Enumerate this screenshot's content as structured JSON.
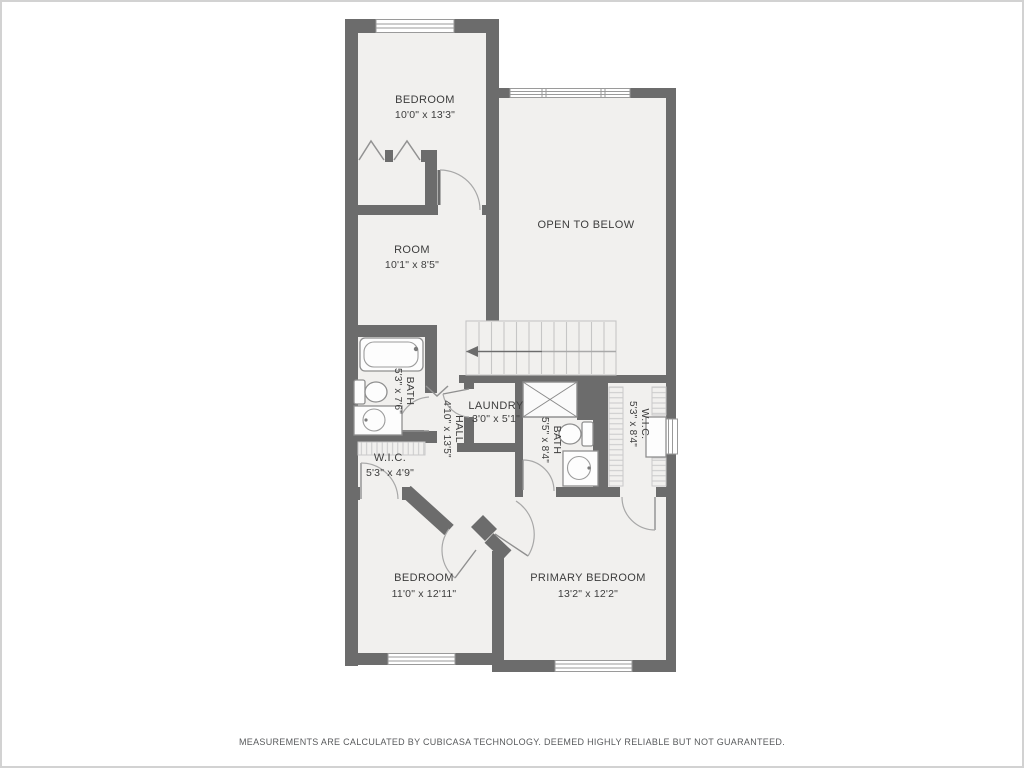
{
  "palette": {
    "wall": "#6c6c6c",
    "room_fill": "#f1f0ee",
    "fixture_stroke": "#8f8f8f",
    "label_text": "#3d3d3d",
    "disclaimer_text": "#585a5c",
    "page_border": "#d2d2d2"
  },
  "rooms": [
    {
      "id": "bedroom-top",
      "name": "BEDROOM",
      "dims": "10'0\" x 13'3\""
    },
    {
      "id": "open-to-below",
      "name": "OPEN TO BELOW",
      "dims": ""
    },
    {
      "id": "room",
      "name": "ROOM",
      "dims": "10'1\" x 8'5\""
    },
    {
      "id": "bath-left",
      "name": "BATH",
      "dims": "5'3\" x 7'6\""
    },
    {
      "id": "hall",
      "name": "HALL",
      "dims": "4'10\" x 13'5\""
    },
    {
      "id": "laundry",
      "name": "LAUNDRY",
      "dims": "3'0\" x 5'1\""
    },
    {
      "id": "bath-middle",
      "name": "BATH",
      "dims": "5'5\" x 8'4\""
    },
    {
      "id": "wic-right",
      "name": "W.I.C.",
      "dims": "5'3\" x 8'4\""
    },
    {
      "id": "wic-left",
      "name": "W.I.C.",
      "dims": "5'3\" x 4'9\""
    },
    {
      "id": "bedroom-bottom",
      "name": "BEDROOM",
      "dims": "11'0\" x 12'11\""
    },
    {
      "id": "primary-bedroom",
      "name": "PRIMARY BEDROOM",
      "dims": "13'2\" x 12'2\""
    }
  ],
  "footer": {
    "disclaimer": "MEASUREMENTS ARE CALCULATED BY CUBICASA TECHNOLOGY. DEEMED HIGHLY RELIABLE BUT NOT GUARANTEED."
  }
}
